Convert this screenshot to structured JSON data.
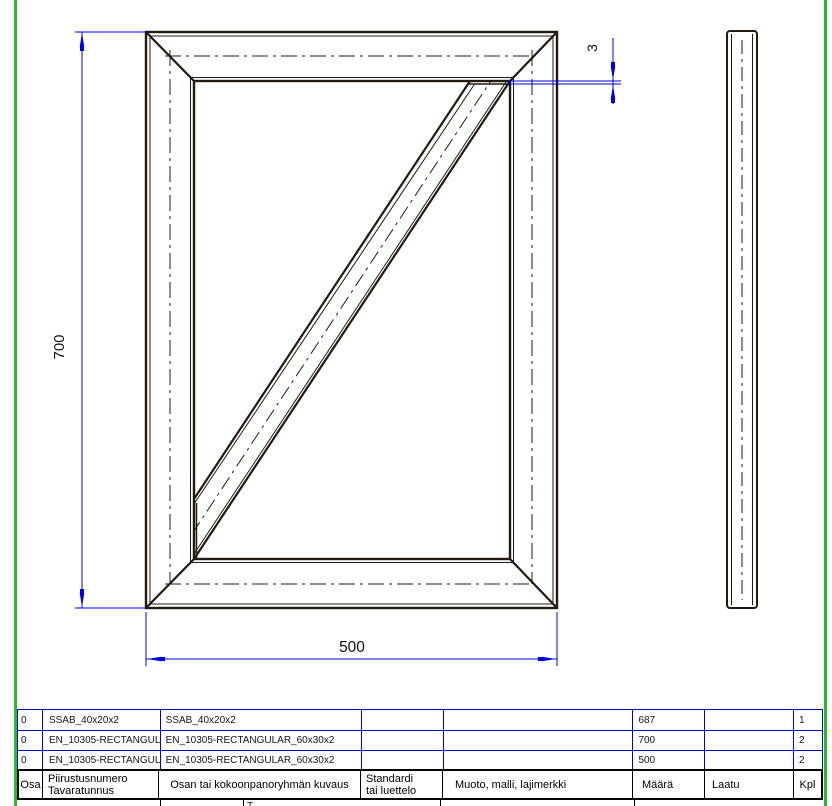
{
  "sheet": {
    "border_color": "#2db92d",
    "drawing_line_color": "#231a0f",
    "dimension_line_color": "#0000dd",
    "table_grid_color": "#0000c4"
  },
  "dimensions": {
    "frame_height": "700",
    "frame_width": "500",
    "brace_gap": "3"
  },
  "table": {
    "headers": {
      "osa": "Osa",
      "drawing_number_line1": "Piirustusnumero",
      "drawing_number_line2": "Tavaratunnus",
      "description": "Osan tai kokoonpanoryhmän kuvaus",
      "standard_line1": "Standardi",
      "standard_line2": "tai luettelo",
      "shape": "Muoto, malli, lajimerkki",
      "quantity": "Määrä",
      "quality": "Laatu",
      "pcs": "Kpl"
    },
    "rows": [
      {
        "osa": "0",
        "drawing_number": "SSAB_40x20x2",
        "description": "SSAB_40x20x2",
        "standard": "",
        "shape": "",
        "quantity": "687",
        "quality": "",
        "pcs": "1"
      },
      {
        "osa": "0",
        "drawing_number": "EN_10305-RECTANGULA...",
        "description": "EN_10305-RECTANGULAR_60x30x2",
        "standard": "",
        "shape": "",
        "quantity": "700",
        "quality": "",
        "pcs": "2"
      },
      {
        "osa": "0",
        "drawing_number": "EN_10305-RECTANGULA...",
        "description": "EN_10305-RECTANGULAR_60x30x2",
        "standard": "",
        "shape": "",
        "quantity": "500",
        "quality": "",
        "pcs": "2"
      }
    ],
    "partial_row_fragment": "T"
  }
}
